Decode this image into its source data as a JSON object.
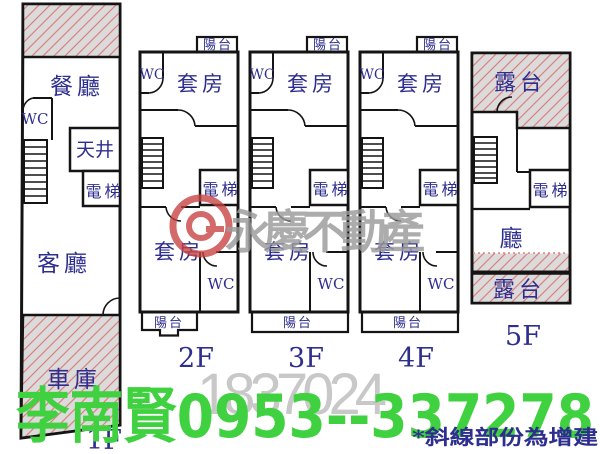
{
  "colors": {
    "wall": "#141414",
    "room_label": "#2e2e8f",
    "hatch_background": "#dbdbdb",
    "hatch_line": "#e08080",
    "watermark_red": "#c84040",
    "watermark_gray": "#9b9b9b",
    "listing_number_gray": "#c6c6c6",
    "contact_green": "#3fd13f"
  },
  "floors": [
    {
      "label": "1F",
      "rooms": {
        "dining": "餐廳",
        "wc": "WC",
        "light_well": "天井",
        "elevator": "電梯",
        "living_room": "客廳",
        "garage": "車庫"
      }
    },
    {
      "label": "2F",
      "rooms": {
        "balcony_top": "陽台",
        "wc_top": "WC",
        "suite_top": "套房",
        "elevator": "電梯",
        "suite_bottom": "套房",
        "wc_bottom": "WC",
        "balcony_bottom": "陽台"
      }
    },
    {
      "label": "3F",
      "rooms": {
        "balcony_top": "陽台",
        "wc_top": "WC",
        "suite_top": "套房",
        "elevator": "電梯",
        "suite_bottom": "套房",
        "wc_bottom": "WC",
        "balcony_bottom": "陽台"
      }
    },
    {
      "label": "4F",
      "rooms": {
        "balcony_top": "陽台",
        "wc_top": "WC",
        "suite_top": "套房",
        "elevator": "電梯",
        "suite_bottom": "套房",
        "wc_bottom": "WC",
        "balcony_bottom": "陽台"
      }
    },
    {
      "label": "5F",
      "rooms": {
        "roof_terrace_top": "露台",
        "elevator": "電梯",
        "hall": "廳",
        "roof_terrace_bottom": "露台"
      }
    }
  ],
  "watermark": {
    "brand": "永慶不動產",
    "listing_number": "1837024"
  },
  "contact": {
    "name": "李南賢",
    "phone": "0953--337278"
  },
  "footnote": {
    "text": "*斜線部份為增建"
  }
}
